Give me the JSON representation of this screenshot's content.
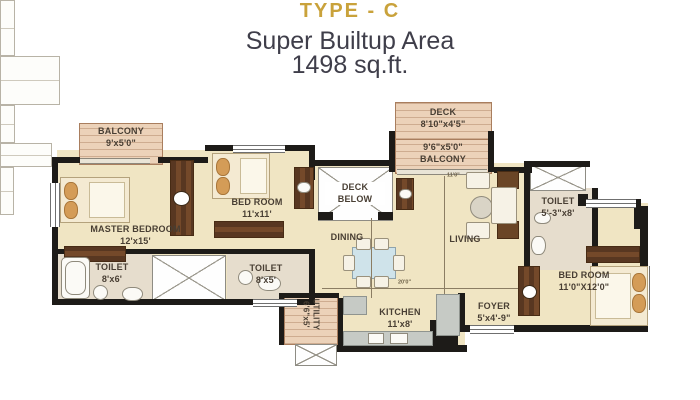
{
  "title": {
    "type_label": "TYPE - C",
    "area_line": "Super Builtup Area",
    "area_value": "1498 sq.ft."
  },
  "rooms": {
    "balcony1": {
      "l1": "BALCONY",
      "l2": "9'x5'0\""
    },
    "master": {
      "l1": "MASTER BEDROOM",
      "l2": "12'x15'"
    },
    "bedroom2": {
      "l1": "BED ROOM",
      "l2": "11'x11'"
    },
    "toilet1": {
      "l1": "TOILET",
      "l2": "8'x6'"
    },
    "toilet2": {
      "l1": "TOILET",
      "l2": "8'x5'"
    },
    "deck_below": {
      "l1": "DECK",
      "l2": "BELOW"
    },
    "dining": {
      "l1": "DINING"
    },
    "deck": {
      "l1": "DECK",
      "l2": "8'10\"x4'5\""
    },
    "balcony2": {
      "l1": "9'6\"x5'0\"",
      "l2": "BALCONY"
    },
    "living": {
      "l1": "LIVING"
    },
    "toilet3": {
      "l1": "TOILET",
      "l2": "5'-3\"x8'"
    },
    "bedroom3": {
      "l1": "BED ROOM",
      "l2": "11'0\"X12'0\""
    },
    "foyer": {
      "l1": "FOYER",
      "l2": "5'x4'-9\""
    },
    "kitchen": {
      "l1": "KITCHEN",
      "l2": "11'x8'"
    },
    "utility": {
      "l1": "UTILITY",
      "l2": "6'6\"x5'"
    }
  },
  "dimensions": {
    "width_label": "20'0\"",
    "living_label": "11'0\""
  },
  "colors": {
    "accent_gold": "#c9a23b",
    "subtitle_text": "#3f3e4a",
    "wall": "#1d1b18",
    "floor_cream": "#f0e5c3",
    "floor_wood": "#ecd2b9",
    "floor_toilet": "#e6ddcd",
    "wood_furniture": "#6a4526",
    "room_label": "#483e33"
  }
}
